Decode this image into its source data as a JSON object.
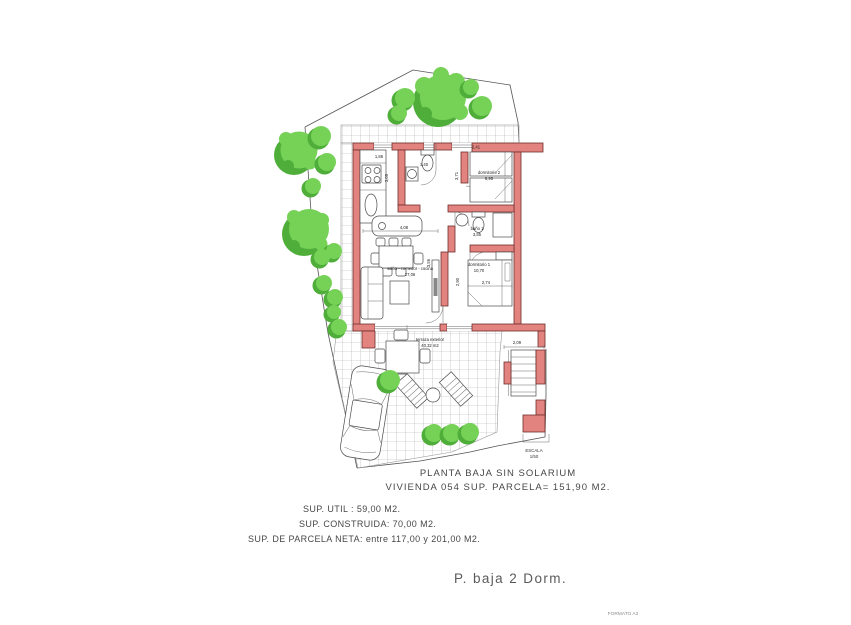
{
  "colors": {
    "wall_fill": "#e2837f",
    "wall_stroke": "#6f2f2c",
    "tree_light": "#76d157",
    "tree_dark": "#4fae3a",
    "grid_line": "#adadad",
    "drawing_line": "#4a4a4a"
  },
  "titles": {
    "line1": "PLANTA BAJA SIN SOLARIUM",
    "line2": "VIVIENDA 054 SUP. PARCELA= 151,90 M2."
  },
  "summary": {
    "util": "SUP. UTIL : 59,00 M2.",
    "construida": "SUP. CONSTRUIDA: 70,00 M2.",
    "parcela": "SUP. DE PARCELA NETA: entre 117,00 y 201,00 M2."
  },
  "footer": {
    "plan_name": "P. baja 2 Dorm.",
    "format": "FORMATO A3"
  },
  "scale": {
    "label": "ESCALA",
    "value": "1/50"
  },
  "rooms": {
    "living": {
      "name": "salón - comedor - cocina",
      "area": "27,06"
    },
    "bedroom2": {
      "name": "dormitorio 2",
      "area": "8,95"
    },
    "bath1": {
      "name": "baño 1",
      "area": "3,85"
    },
    "bedroom1": {
      "name": "dormitorio 1",
      "area": "10,70"
    },
    "terrace": {
      "name": "terraza exterior",
      "area": "40,32 m2"
    }
  },
  "dims": {
    "kitchen_w": "1,86",
    "kitchen_h": "3,05",
    "wc_w": "1,40",
    "living_w": "4,08",
    "living_h": "3,56",
    "bed2_w": "2,41",
    "bed2_h": "3,71",
    "bed1_w": "2,74",
    "bed1_h": "2,90",
    "stairs_w": "2,09"
  }
}
